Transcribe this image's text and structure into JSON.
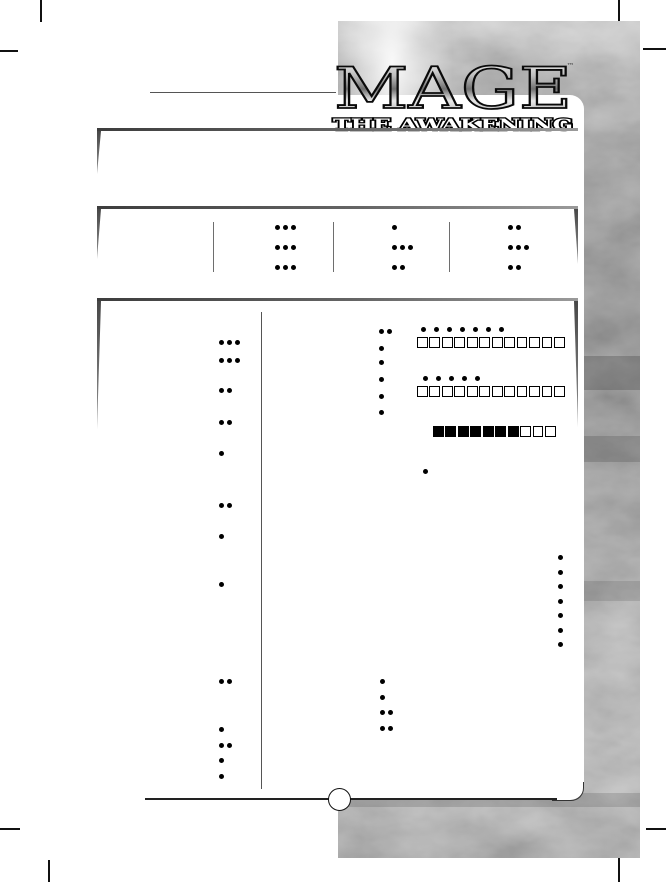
{
  "logo": {
    "title": "MAGE",
    "subtitle": "THE AWAKENING",
    "trademark": "™"
  },
  "colors": {
    "paper": "#ffffff",
    "ink": "#000000",
    "frame": "#4e4e4e",
    "texture_mid": "#7a7a7a"
  },
  "attributes": {
    "columns": [
      {
        "dots": [
          3,
          3,
          3
        ]
      },
      {
        "dots": [
          1,
          3,
          2
        ]
      },
      {
        "dots": [
          2,
          3,
          2
        ]
      }
    ]
  },
  "skills": {
    "dots": [
      3,
      3,
      2,
      2,
      1,
      2,
      1,
      1,
      2,
      1,
      2,
      1,
      1
    ]
  },
  "arcana": {
    "dots": [
      2,
      1,
      1,
      1,
      1,
      1
    ]
  },
  "merits": {
    "dots": [
      1,
      1,
      2,
      2
    ]
  },
  "health": {
    "dots": 7,
    "boxes": 12,
    "filled": 0
  },
  "willpower": {
    "dots": 5,
    "boxes": 12,
    "filled": 0
  },
  "mana": {
    "boxes": 10,
    "filled": 7
  },
  "gnosis": {
    "dots": 1
  },
  "wisdom": {
    "dots": 7
  }
}
